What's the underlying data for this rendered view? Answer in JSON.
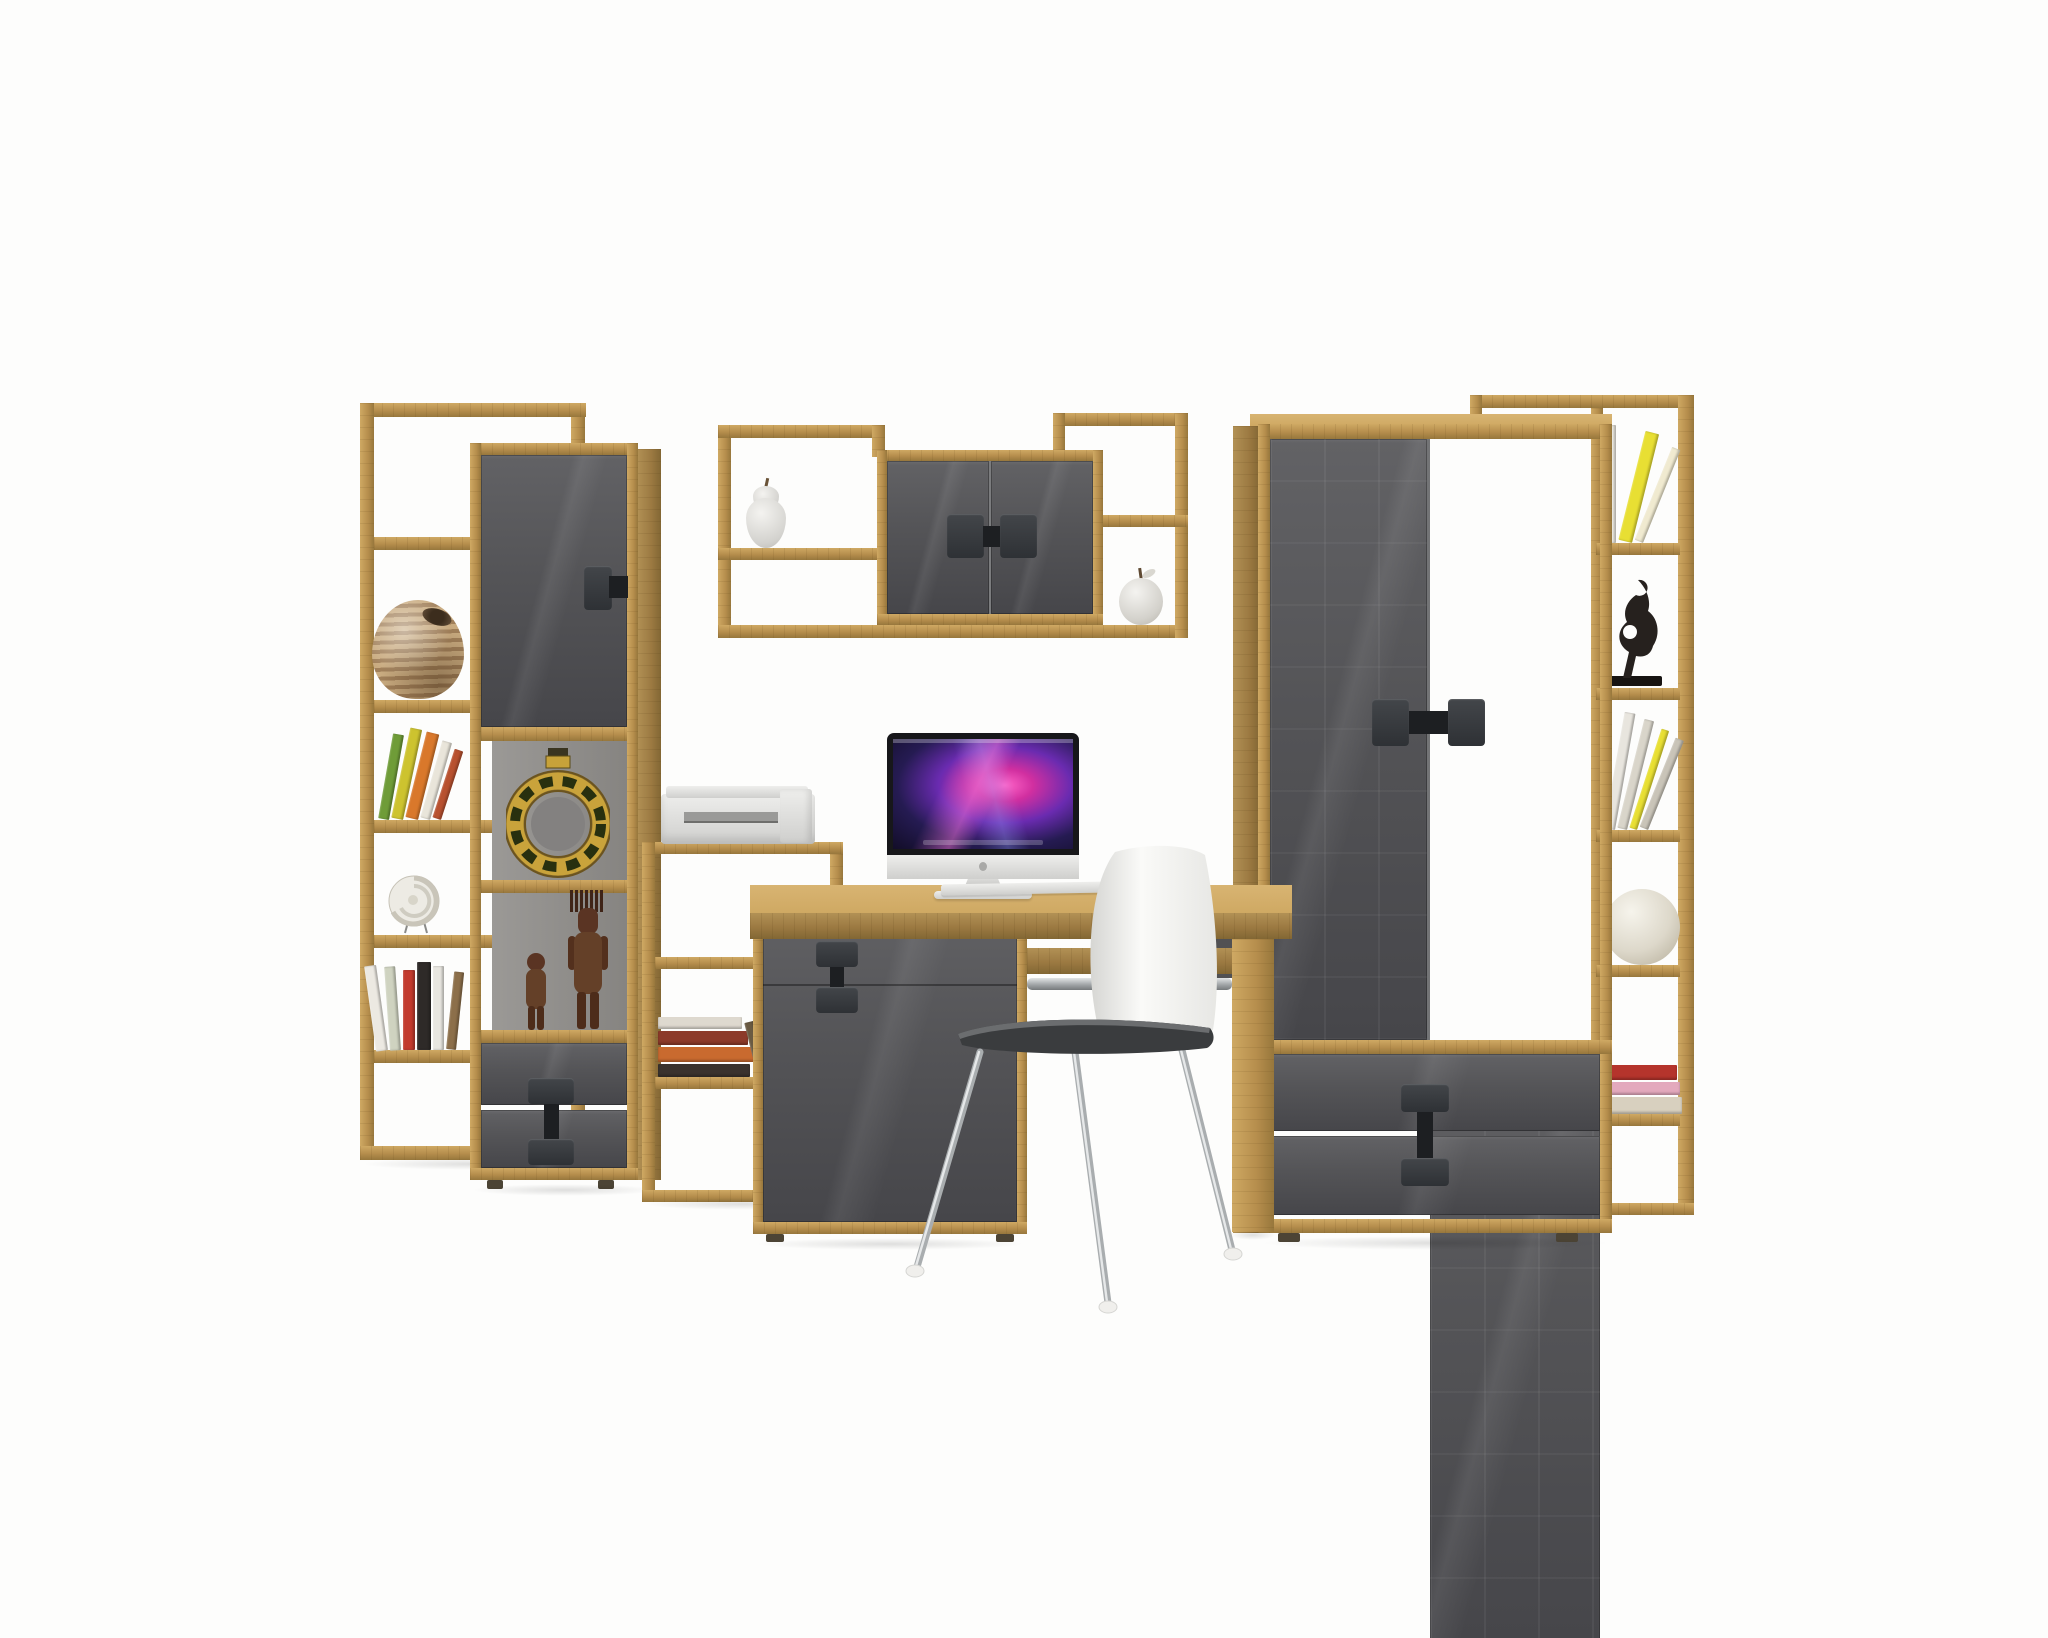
{
  "meta": {
    "description": "Product photo on white background: modern youth-room furniture wall set in artisan oak and grey gloss — tall open shelf, tall cabinet, wall shelf with two-door cabinet, computer desk with side cabinet, iMac-style computer, printer, white shell chair with chrome legs, two-door wardrobe with drawers and a tall narrow bookshelf decorated with books, vases, shells, figurines and fruit ornaments.",
    "background": "#fdfdfc"
  },
  "colors": {
    "oak": "#b58d4c",
    "oakL": "#cfa963",
    "oakD": "#97773c",
    "gl": "#545457",
    "glL": "#626265",
    "glD": "#46464a",
    "hd": "#34373b",
    "hdD": "#1d1f22",
    "int": "#908e8b",
    "chrome": "#b6babc",
    "chromeD": "#85898b",
    "shell": "#f5f5f3",
    "seat": "#3a3c3e",
    "scr": "#150f2f"
  },
  "furniture": {
    "left_shelf": {
      "label": "tall open shelving unit, artisan oak"
    },
    "left_cabinet": {
      "label": "tall cabinet: grey gloss door, two open cells, two drawers"
    },
    "printer_stand": {
      "label": "low open shelf stand with printer"
    },
    "wall_shelf": {
      "label": "wall shelf with two-door grey gloss cabinet"
    },
    "desk": {
      "label": "computer desk with grey gloss side cabinet"
    },
    "wardrobe": {
      "label": "two-door wardrobe with drawer unit, grey gloss fronts"
    },
    "right_shelf": {
      "label": "tall narrow open bookshelf, artisan oak"
    },
    "chair": {
      "label": "white shell chair with chrome legs"
    }
  },
  "decor": {
    "imac": "silver all-in-one computer with pink-purple galaxy wallpaper",
    "keyboard": "white keyboard",
    "mouse": "white mouse",
    "printer": "white inkjet printer",
    "striped_vase": "round striped clay vase",
    "spiral_shell": "white spiral shell on wire stand",
    "ring_vase": "gold ring-shaped ethnic vase",
    "figurine_tall": "tall carved wooden figure",
    "figurine_small": "small carved wooden figure",
    "black_sculpture": "black abstract figure sculpture",
    "white_sphere": "white decorative sphere",
    "pear": "white pear ornament",
    "apple": "white apple ornament"
  },
  "books": {
    "left_lean": [
      {
        "c": "#6f9c38",
        "w": 11,
        "h": 86,
        "r": 10
      },
      {
        "c": "#cdc32f",
        "w": 12,
        "h": 92,
        "r": 12
      },
      {
        "c": "#d9782b",
        "w": 13,
        "h": 88,
        "r": 14
      },
      {
        "c": "#e9e5da",
        "w": 10,
        "h": 80,
        "r": 16
      },
      {
        "c": "#b8512f",
        "w": 9,
        "h": 72,
        "r": 18
      }
    ],
    "left_row": [
      {
        "c": "#ece9e2",
        "w": 12,
        "h": 86,
        "r": -8
      },
      {
        "c": "#cfd3c0",
        "w": 11,
        "h": 84,
        "r": -4
      },
      {
        "c": "#c23b2e",
        "w": 12,
        "h": 80,
        "r": 0
      },
      {
        "c": "#2e2a28",
        "w": 14,
        "h": 88,
        "r": 0
      },
      {
        "c": "#e8e6e0",
        "w": 11,
        "h": 84,
        "r": 0
      },
      {
        "c": "#8c6f4a",
        "w": 10,
        "h": 78,
        "r": 6
      }
    ],
    "stand_stack": [
      {
        "c": "#3a332e",
        "w": 92,
        "h": 13
      },
      {
        "c": "#c96a2f",
        "w": 96,
        "h": 15
      },
      {
        "c": "#8c3a2a",
        "w": 90,
        "h": 14
      },
      {
        "c": "#ded9cf",
        "w": 84,
        "h": 12
      }
    ],
    "stand_lean": [
      {
        "c": "#6a5a42",
        "w": 10,
        "h": 58,
        "r": -14
      },
      {
        "c": "#c9c4ba",
        "w": 9,
        "h": 54,
        "r": -18
      }
    ],
    "right_top": [
      {
        "c": "#efece4",
        "w": 12,
        "h": 118,
        "r": 0
      },
      {
        "c": "#e8df33",
        "w": 14,
        "h": 112,
        "r": 14
      },
      {
        "c": "#f0ead0",
        "w": 9,
        "h": 100,
        "r": 22
      }
    ],
    "right_mid": [
      {
        "c": "#e8e5de",
        "w": 11,
        "h": 118,
        "r": 10
      },
      {
        "c": "#d9d5ca",
        "w": 10,
        "h": 112,
        "r": 14
      },
      {
        "c": "#e8df33",
        "w": 8,
        "h": 104,
        "r": 18
      },
      {
        "c": "#c9c4b8",
        "w": 9,
        "h": 96,
        "r": 22
      }
    ],
    "right_stack": [
      {
        "c": "#d8d0bf",
        "w": 80,
        "h": 17
      },
      {
        "c": "#e3a9bd",
        "w": 78,
        "h": 13
      },
      {
        "c": "#b5342c",
        "w": 75,
        "h": 15
      }
    ]
  }
}
